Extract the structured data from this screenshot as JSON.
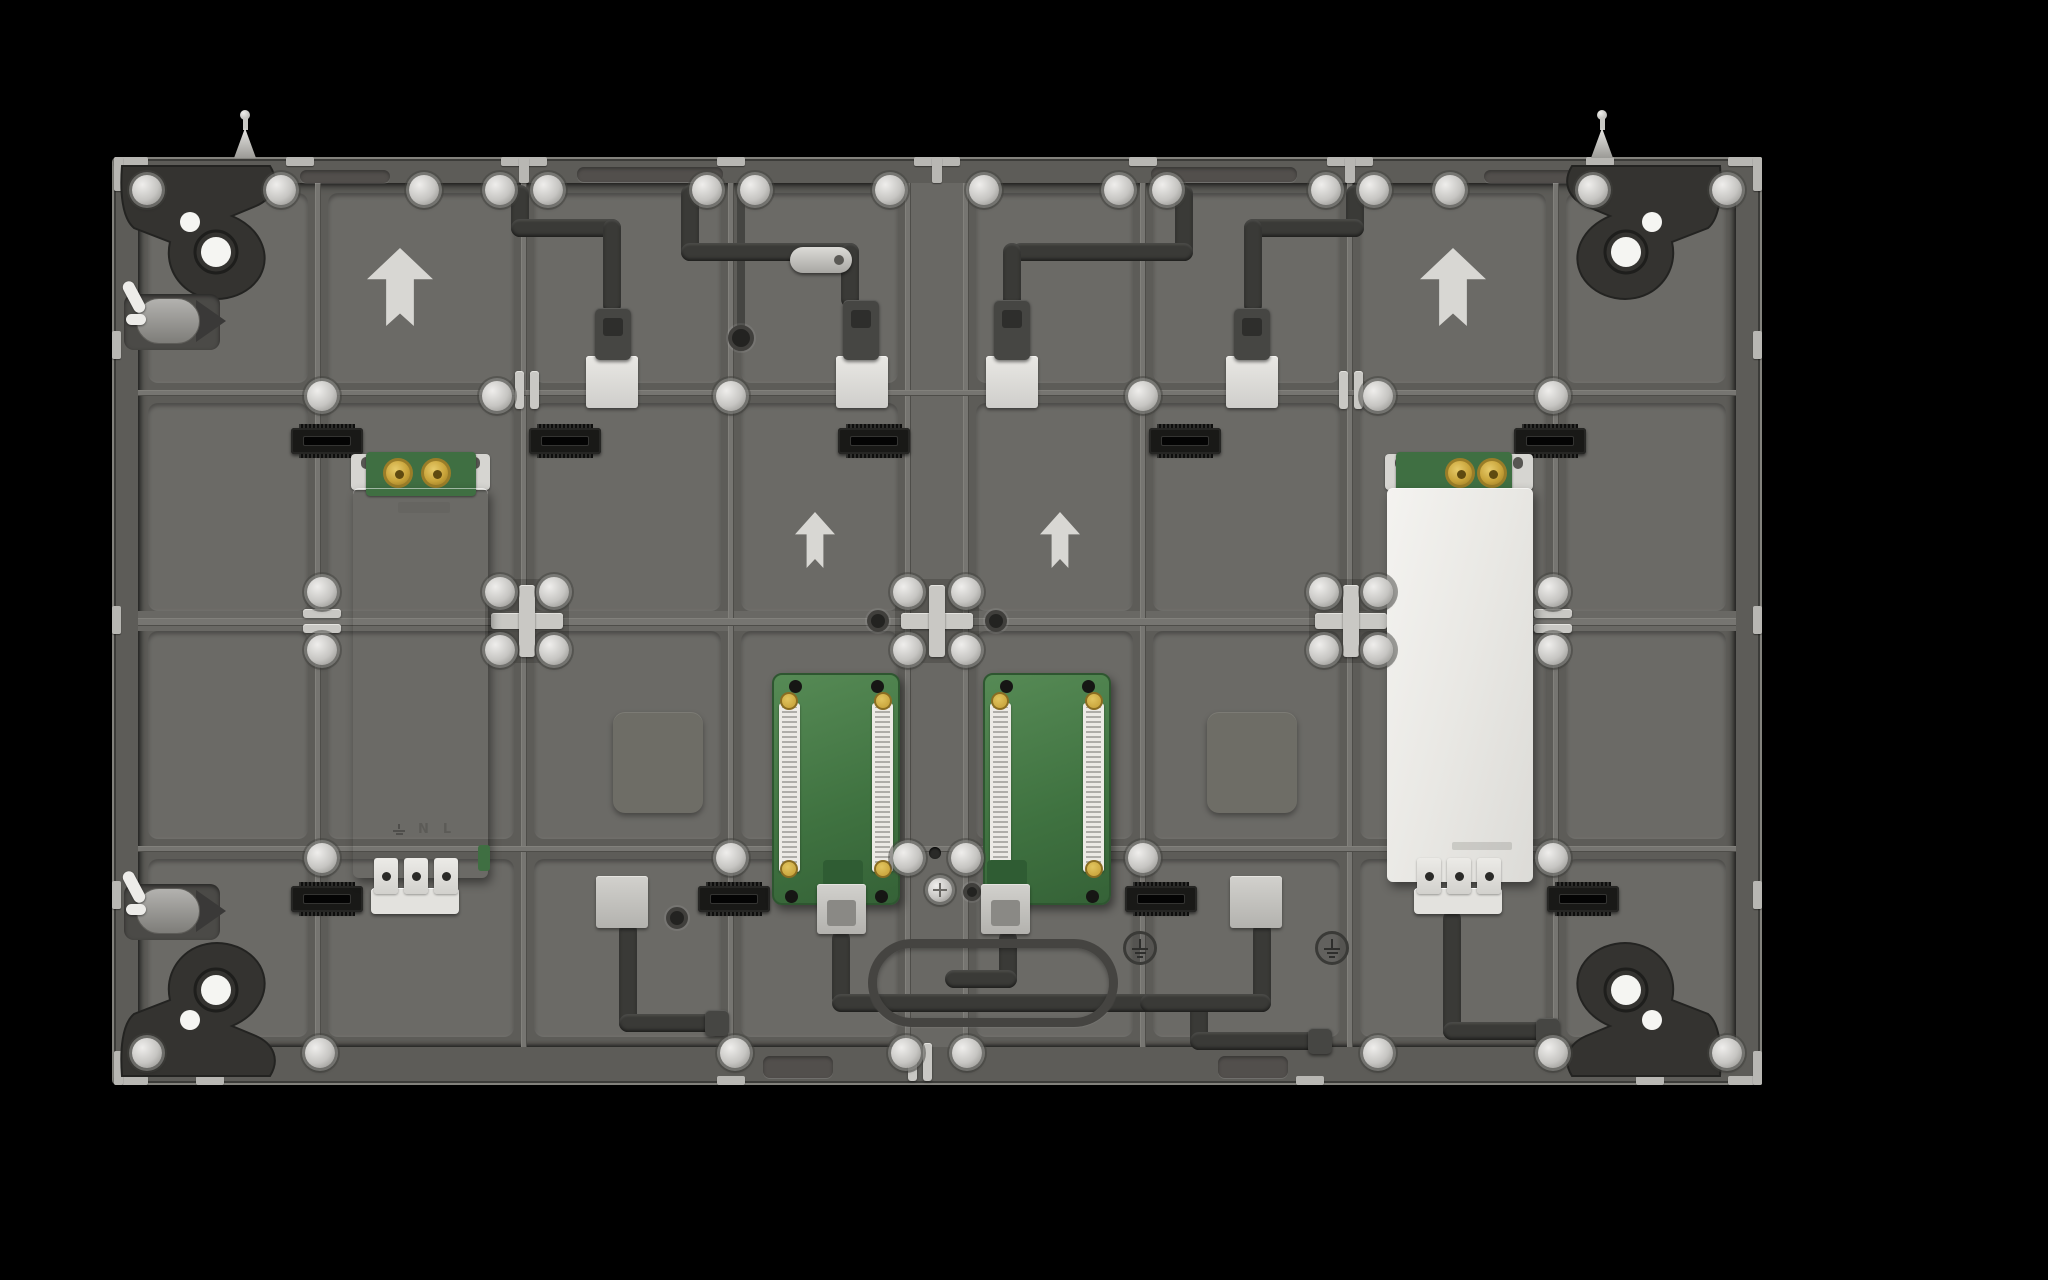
{
  "scene": {
    "description": "Rear view 3D render of an LED video-wall cabinet back panel on a black background",
    "background": "#000000"
  },
  "colors": {
    "panel": "#6f6e6a",
    "panel_cell": "#6b6a66",
    "frame": "#5d5c58",
    "frame_edge": "#83827d",
    "rib_light": "#82817c",
    "rib_dark": "#4e4d49",
    "rivet_silver": "#cfcecb",
    "bracket_light": "#c9c8c4",
    "tab_light": "#b8b7b3",
    "arrow_gray": "#d8d7d3",
    "cable_charcoal": "#3a3a37",
    "connector_black": "#191917",
    "socket_white": "#dcdbd7",
    "socket_gray": "#c6c5c1",
    "psu_left_silver": "#bcbbb8",
    "psu_right_white": "#efeeea",
    "terminal_block": "#e3e2de",
    "pcb_green": "#47774a",
    "pcb_strip_white": "#eceae5",
    "gold_terminal": "#cfa93e",
    "gusset_dark": "#343330",
    "oval_guide": "#454441",
    "ground_mark": "#2e2e2c"
  },
  "inventory": {
    "power_supplies": 2,
    "receiving_card_pcbs": 2,
    "lifting_eyebolts": 2,
    "corner_gussets": 4,
    "direction_arrows": 4,
    "alignment_crosses": 3,
    "ground_marks": 2,
    "signal_sockets": 4,
    "edge_latches": 2,
    "black_board_connectors": 9
  },
  "labels": {
    "psu_terminal_n": "N",
    "psu_terminal_l": "L",
    "arrow_direction": "up"
  }
}
